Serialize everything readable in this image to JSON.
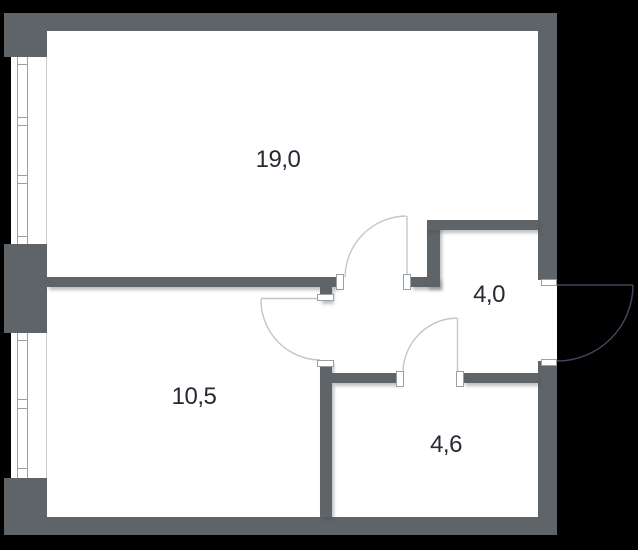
{
  "plan_title": "apartment-floor-plan",
  "rooms": [
    {
      "label": "19,0"
    },
    {
      "label": "10,5"
    },
    {
      "label": "4,0"
    },
    {
      "label": "4,6"
    }
  ],
  "colors": {
    "background": "#000000",
    "floor": "#ffffff",
    "wall": "#5f6468",
    "window_line": "#9ba0a4",
    "window_edge": "#cdd0d2",
    "interior_door": "#c3c6c8",
    "entrance_door": "#3e4857",
    "label_text": "#252a33"
  }
}
